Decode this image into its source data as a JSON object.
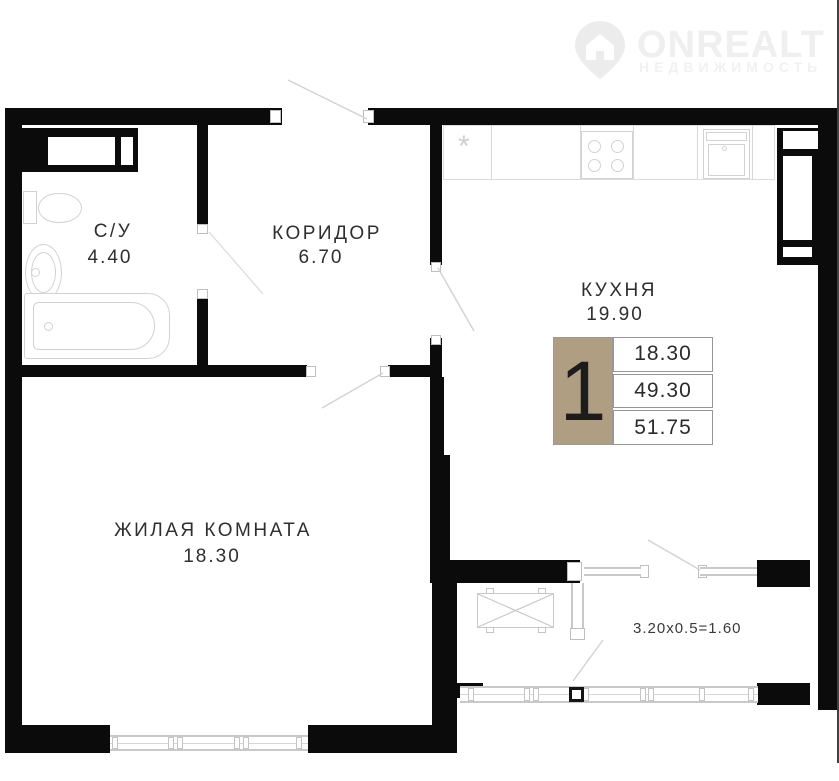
{
  "watermark": {
    "brand": "ONREALT",
    "tagline": "НЕДВИЖИМОСТЬ"
  },
  "plan": {
    "rooms": [
      {
        "name": "С/У",
        "area": "4.40"
      },
      {
        "name": "КОРИДОР",
        "area": "6.70"
      },
      {
        "name": "КУХНЯ",
        "area": "19.90"
      },
      {
        "name": "ЖИЛАЯ КОМНАТА",
        "area": "18.30"
      }
    ],
    "balcony_label": "3.20x0.5=1.60",
    "fridge_mark": "*",
    "info_badge": {
      "room_count": "1",
      "rows": [
        "18.30",
        "49.30",
        "51.75"
      ],
      "tan_color": "#af9e81"
    }
  },
  "colors": {
    "wall": "#0b0b0b",
    "fixture_line": "#d2d2d2",
    "label_text": "#2f2f2f"
  }
}
